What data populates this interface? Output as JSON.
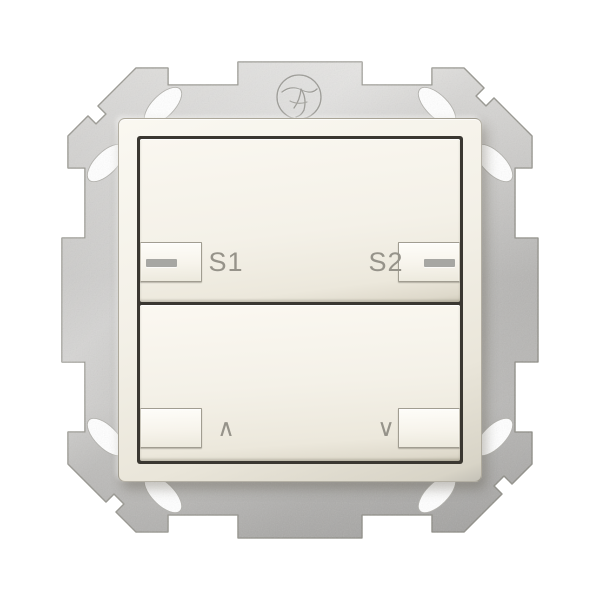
{
  "buttons": {
    "top_rocker": {
      "left": {
        "label": "S1",
        "indicator": "dash"
      },
      "right": {
        "label": "S2",
        "indicator": "dash"
      }
    },
    "bottom_rocker": {
      "left": {
        "label": "∧",
        "indicator": "none"
      },
      "right": {
        "label": "∨",
        "indicator": "none"
      }
    }
  },
  "plate": {
    "stamp_icon": "certification-stamp-icon",
    "claw_slot_count": 8
  },
  "colors": {
    "background": "#ffffff",
    "metal_light": "#d7d6d4",
    "metal_mid": "#c2c1bf",
    "metal_dark": "#b3b2b0",
    "frame_cream": "#f3f0e7",
    "rocker_cream": "#f4f1e8",
    "label_gray": "#96938a",
    "indicator_gray": "#a7a7a3",
    "seam_dark": "#3a3731"
  }
}
